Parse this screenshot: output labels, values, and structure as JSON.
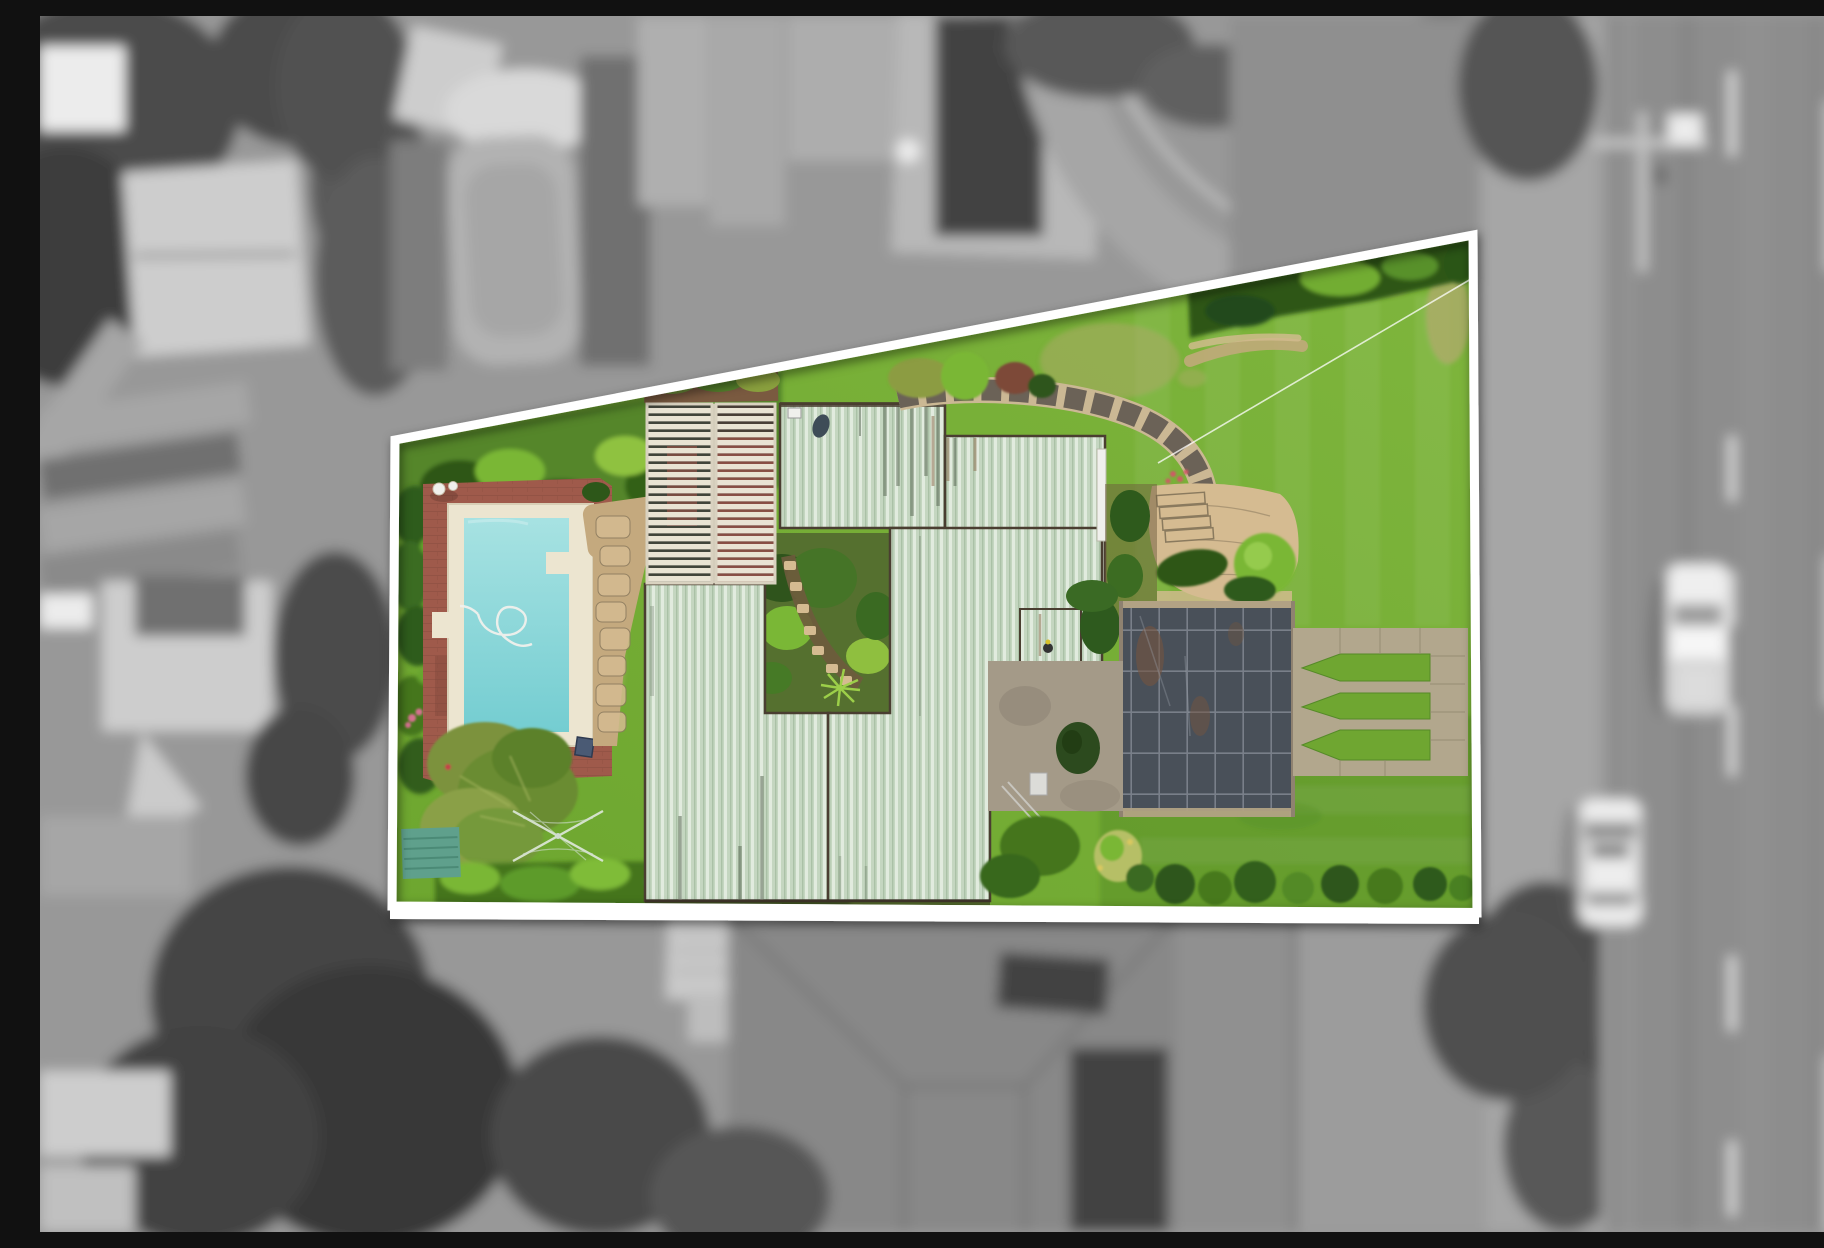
{
  "scene": {
    "type": "aerial-drone-photograph",
    "title": "Aerial view of a highlighted property lot",
    "description": "Top-down real-estate drone photo. The subject lot is shown in full colour inside a white trapezoid boundary outline, while the surrounding suburb is desaturated grey and blurred. Inside the lot: pale-green corrugated metal roofs, a cream louvred pergola, a turquoise swimming pool with cream coping on a red brick deck, a white statue, lush hedges, an inner courtyard garden with stepping stones, a curved stone retaining wall with steps and flagstone patio, a dark shade-roof structure, a gravel court, pointed lawn islands between concrete paths, a rotary clothesline, a teal garden shed and a large back lawn. Outside: grey houses, a neighbour pool, rooftop solar panels, trees, and a vertical road on the right with dashed lane lines, a white ute and a white car with roof rails."
  },
  "palette": {
    "bgBase": "#989898",
    "road": "#8d8d8d",
    "verge": "#a6a6a6",
    "lightRoof": "#cdcdcd",
    "midRoof": "#a9a9a9",
    "darkTree": "#4c4c4c",
    "darkTree2": "#3c3c3c",
    "solarDark": "#3e3e3e",
    "solarLine": "#5d5d5d",
    "whiteObj": "#ececec",
    "grayLine": "#c9c9c9",
    "shadowGray": "#6f6f6f",
    "lawn": "#6da62f",
    "lawnLight": "#7fb63d",
    "lawnDark": "#538a25",
    "lawnWorn": "#b3a96f",
    "hedgeBase": "#55862c",
    "hedgeDark": "#2d5719",
    "hedgeMid": "#44751f",
    "hedgeBright": "#7ab736",
    "hedgeOlive": "#8c9c42",
    "hedgeYellow": "#b6bf66",
    "roofBase": "#c4d6c0",
    "roofRib": "#e1ebde",
    "roofRibDark": "#aac1a6",
    "roofStreak": "#5d6b58",
    "roofRust": "#8a6a4a",
    "gutter": "#4a3e31",
    "slat": "#e9e3d3",
    "slatGapDark": "#42453b",
    "pergolaDeck": "#8a5046",
    "coping": "#ece5d0",
    "poolTop": "#a7e2e2",
    "poolBottom": "#74cdd1",
    "deckBrick": "#9f5a4b",
    "deckJoint": "#7c4438",
    "stonePath": "#c4a97e",
    "stoneLight": "#d5bb91",
    "stoneDark": "#8a7a5e",
    "wallDark": "#6b6257",
    "wallLight": "#cbb894",
    "pathConcrete": "#b2a78d",
    "pathJoint": "#8f866e",
    "shadeRoof": "#495059",
    "shadeGrid": "#7e848e",
    "shadeRust": "#74543f",
    "shadeFrame": "#b2a284",
    "gravel": "#a49a88",
    "soil": "#6e5b3d",
    "shedTeal": "#5fa08c",
    "shedTealDark": "#4b8a76",
    "flowerRed": "#c4404a",
    "flowerPink": "#d4718f",
    "white": "#ffffff",
    "offWhite": "#f0f0ec"
  },
  "property": {
    "boundary_points": "355,424 1433,219 1437,897 352,890",
    "outline_color": "#ffffff",
    "features": [
      "perimeter hedges",
      "turquoise swimming pool with cream coping",
      "red brick pool deck",
      "white garden statue",
      "pool hose in water",
      "stone crazy paving beside pool",
      "cream louvred pergola (two bays)",
      "pale green corrugated metal roofs",
      "inner courtyard garden with stepping stones and fern",
      "curved stone retaining wall",
      "garden steps and flagstone patio",
      "dark grid shade-roof structure",
      "gravel courtyard",
      "small tree and air-conditioner unit",
      "three pointed lawn islands between concrete paths",
      "large back lawn with worn patches",
      "diagonal clothesline wire",
      "rotary clothesline",
      "teal garden shed",
      "row of round clipped shrubs",
      "red and pink flowers"
    ]
  },
  "surroundings": {
    "features": [
      "blurred monochrome neighbouring houses",
      "neighbour swimming pool and white deck",
      "rooftop solar panel arrays",
      "vertical road with dashed lane markings",
      "white utility vehicle",
      "white car with roof rails",
      "street light pole with crossarm",
      "dark tree canopies",
      "light shade sail",
      "driveways and paths"
    ]
  }
}
